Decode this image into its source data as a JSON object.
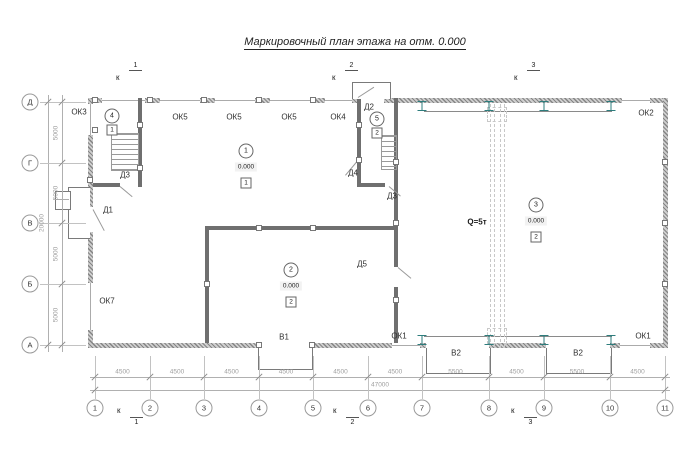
{
  "title": "Маркировочный план этажа на отм. 0.000",
  "colors": {
    "wall": "#858585",
    "thin_line": "#b0b0b0",
    "dim_text": "#9e9e9e",
    "label_text": "#2e2e2e",
    "steel_column": "#2e7d7d",
    "crane_dash": "#c8c8c8"
  },
  "axes": {
    "bottom_numbers": [
      "1",
      "2",
      "3",
      "4",
      "5",
      "6",
      "7",
      "8",
      "9",
      "10",
      "11"
    ],
    "left_letters": [
      "Д",
      "Г",
      "В",
      "Б",
      "А"
    ]
  },
  "dimensions": {
    "bottom_segments": [
      "4500",
      "4500",
      "4500",
      "4500",
      "4500",
      "4500",
      "5500",
      "4500",
      "5500",
      "4500"
    ],
    "bottom_total": "47000",
    "left_segments": [
      "5000",
      "5000",
      "5000",
      "5000"
    ],
    "left_total": "20000"
  },
  "section_marks": {
    "letter": "к",
    "top_numbers": [
      "1",
      "2",
      "3"
    ],
    "bottom_numbers": [
      "1",
      "2",
      "3"
    ]
  },
  "plan_labels": [
    {
      "text": "ОК3",
      "kind": "window",
      "x": 79,
      "y": 112
    },
    {
      "text": "ОК5",
      "kind": "window",
      "x": 180,
      "y": 117
    },
    {
      "text": "ОК5",
      "kind": "window",
      "x": 234,
      "y": 117
    },
    {
      "text": "ОК5",
      "kind": "window",
      "x": 289,
      "y": 117
    },
    {
      "text": "ОК4",
      "kind": "window",
      "x": 338,
      "y": 117
    },
    {
      "text": "Д2",
      "kind": "door",
      "x": 369,
      "y": 107
    },
    {
      "text": "ОК2",
      "kind": "window",
      "x": 646,
      "y": 113
    },
    {
      "text": "Д3",
      "kind": "door",
      "x": 125,
      "y": 175
    },
    {
      "text": "Д4",
      "kind": "door",
      "x": 353,
      "y": 173
    },
    {
      "text": "Д3",
      "kind": "door",
      "x": 392,
      "y": 196
    },
    {
      "text": "Д1",
      "kind": "door",
      "x": 108,
      "y": 210
    },
    {
      "text": "Д5",
      "kind": "door",
      "x": 362,
      "y": 264
    },
    {
      "text": "ОК7",
      "kind": "window",
      "x": 107,
      "y": 301
    },
    {
      "text": "Q=5т",
      "kind": "crane",
      "x": 477,
      "y": 222
    },
    {
      "text": "В1",
      "kind": "gate",
      "x": 284,
      "y": 337
    },
    {
      "text": "ОК1",
      "kind": "window",
      "x": 399,
      "y": 336
    },
    {
      "text": "В2",
      "kind": "gate",
      "x": 456,
      "y": 353
    },
    {
      "text": "В2",
      "kind": "gate",
      "x": 578,
      "y": 353
    },
    {
      "text": "ОК1",
      "kind": "window",
      "x": 643,
      "y": 336
    }
  ],
  "room_markers": [
    {
      "number": "1",
      "elevation": "0.000",
      "finish": "1",
      "x": 246,
      "y": 151
    },
    {
      "number": "2",
      "elevation": "0.000",
      "finish": "2",
      "x": 291,
      "y": 270
    },
    {
      "number": "3",
      "elevation": "0.000",
      "finish": "2",
      "x": 536,
      "y": 205
    },
    {
      "number": "4",
      "elevation": "",
      "finish": "1",
      "x": 112,
      "y": 116
    },
    {
      "number": "5",
      "elevation": "",
      "finish": "2",
      "x": 377,
      "y": 119
    }
  ]
}
